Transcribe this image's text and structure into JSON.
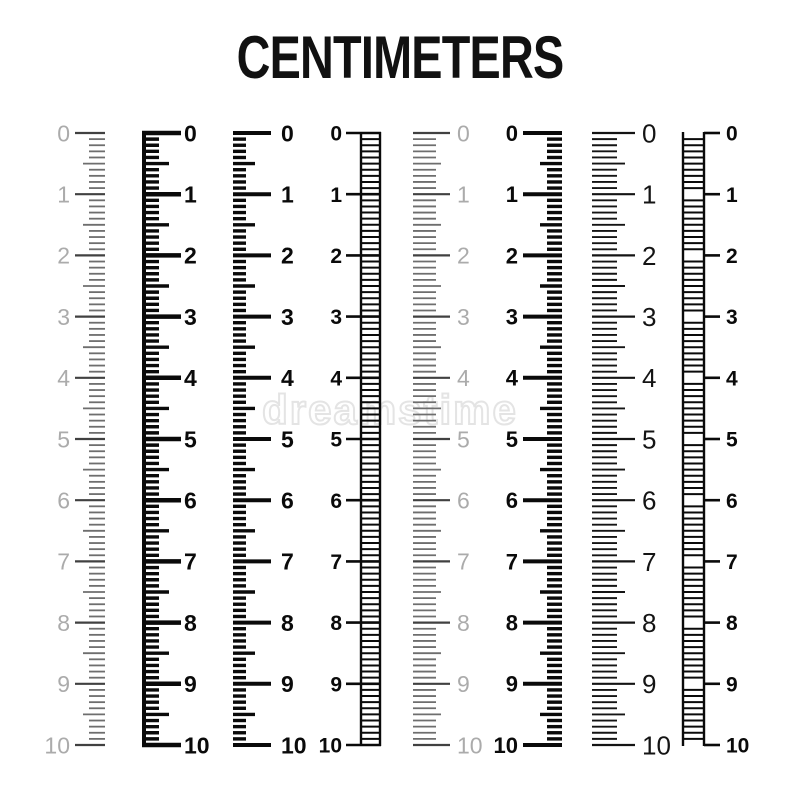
{
  "title": "CENTIMETERS",
  "watermark": "dreamstime",
  "colors": {
    "background": "#ffffff",
    "ink": "#0a0a0a",
    "thin_ink": "#141414",
    "dark_gray": "#414141",
    "mid_gray": "#6e6e6e",
    "light_gray": "#ababab",
    "watermark": "#e4e4e4"
  },
  "scale": {
    "unit": "centimeters",
    "min": 0,
    "max": 10,
    "minor_per_cm": 10,
    "cm_labels": [
      "0",
      "1",
      "2",
      "3",
      "4",
      "5",
      "6",
      "7",
      "8",
      "9",
      "10"
    ],
    "top_y": 133,
    "bottom_y": 745
  },
  "rulers": [
    {
      "name": "ruler-1-thin-gray-labels-left",
      "style": "ticks",
      "edge_x": 105,
      "dir": -1,
      "len_cm": 30,
      "len_half": 22,
      "len_mm": 16,
      "stroke": 1.8,
      "stroke_cm": 2.2,
      "tick_color_key": "mid_gray",
      "cm_color_key": "dark_gray",
      "label_x": 70,
      "label_anchor": "end",
      "label_size": 23,
      "label_weight": "normal",
      "label_color_key": "light_gray"
    },
    {
      "name": "ruler-2-baseline-bold-labels-right",
      "style": "baseline",
      "edge_x": 142,
      "baseline_w": 4,
      "dir": 1,
      "len_cm": 39,
      "len_half": 27,
      "len_mm": 17,
      "stroke": 3.4,
      "stroke_cm": 4.5,
      "tick_color_key": "ink",
      "cm_color_key": "ink",
      "label_x": 184,
      "label_anchor": "start",
      "label_size": 23,
      "label_weight": "bold",
      "label_color_key": "ink"
    },
    {
      "name": "ruler-3-bold-ticks-labels-right",
      "style": "ticks",
      "edge_x": 233,
      "dir": 1,
      "len_cm": 38,
      "len_half": 22,
      "len_mm": 13,
      "stroke": 3.4,
      "stroke_cm": 4,
      "tick_color_key": "ink",
      "cm_color_key": "ink",
      "label_x": 281,
      "label_anchor": "start",
      "label_size": 23,
      "label_weight": "bold",
      "label_color_key": "ink"
    },
    {
      "name": "ruler-4-ladder-labels-left",
      "style": "ladder",
      "rail1": 361,
      "rail2": 380,
      "rail_w": 2.4,
      "rung_w": 2,
      "cm_from": 346,
      "cm_to": 381,
      "cm_w": 2.6,
      "tick_color_key": "ink",
      "cm_color_key": "ink",
      "label_x": 342,
      "label_anchor": "end",
      "label_size": 21,
      "label_weight": "bold",
      "label_color_key": "ink"
    },
    {
      "name": "ruler-5-thin-gray-labels-right",
      "style": "ticks",
      "edge_x": 413,
      "dir": 1,
      "len_cm": 37,
      "len_half": 28,
      "len_mm": 23,
      "stroke": 1.8,
      "stroke_cm": 2.2,
      "tick_color_key": "mid_gray",
      "cm_color_key": "dark_gray",
      "label_x": 457,
      "label_anchor": "start",
      "label_size": 23,
      "label_weight": "normal",
      "label_color_key": "light_gray"
    },
    {
      "name": "ruler-6-bold-ticks-labels-left",
      "style": "ticks",
      "edge_x": 562,
      "dir": -1,
      "len_cm": 39,
      "len_half": 22,
      "len_mm": 15,
      "stroke": 3.4,
      "stroke_cm": 4,
      "tick_color_key": "ink",
      "cm_color_key": "ink",
      "label_x": 518,
      "label_anchor": "end",
      "label_size": 22,
      "label_weight": "bold",
      "label_color_key": "ink"
    },
    {
      "name": "ruler-7-thin-black-labels-right",
      "style": "ticks",
      "edge_x": 592,
      "dir": 1,
      "len_cm": 43,
      "len_half": 33,
      "len_mm": 25,
      "stroke": 1.9,
      "stroke_cm": 2.2,
      "tick_color_key": "thin_ink",
      "cm_color_key": "thin_ink",
      "label_x": 642,
      "label_anchor": "start",
      "label_size": 26,
      "label_weight": "normal",
      "label_color_key": "thin_ink"
    },
    {
      "name": "ruler-8-ladder-labels-right",
      "style": "ladder",
      "rail1": 683,
      "rail2": 704,
      "rail_w": 2.4,
      "rung_w": 2,
      "cm_from": 704,
      "cm_to": 720,
      "cm_w": 2.6,
      "tick_color_key": "ink",
      "cm_color_key": "ink",
      "label_x": 726,
      "label_anchor": "start",
      "label_size": 21,
      "label_weight": "bold",
      "label_color_key": "ink"
    }
  ]
}
